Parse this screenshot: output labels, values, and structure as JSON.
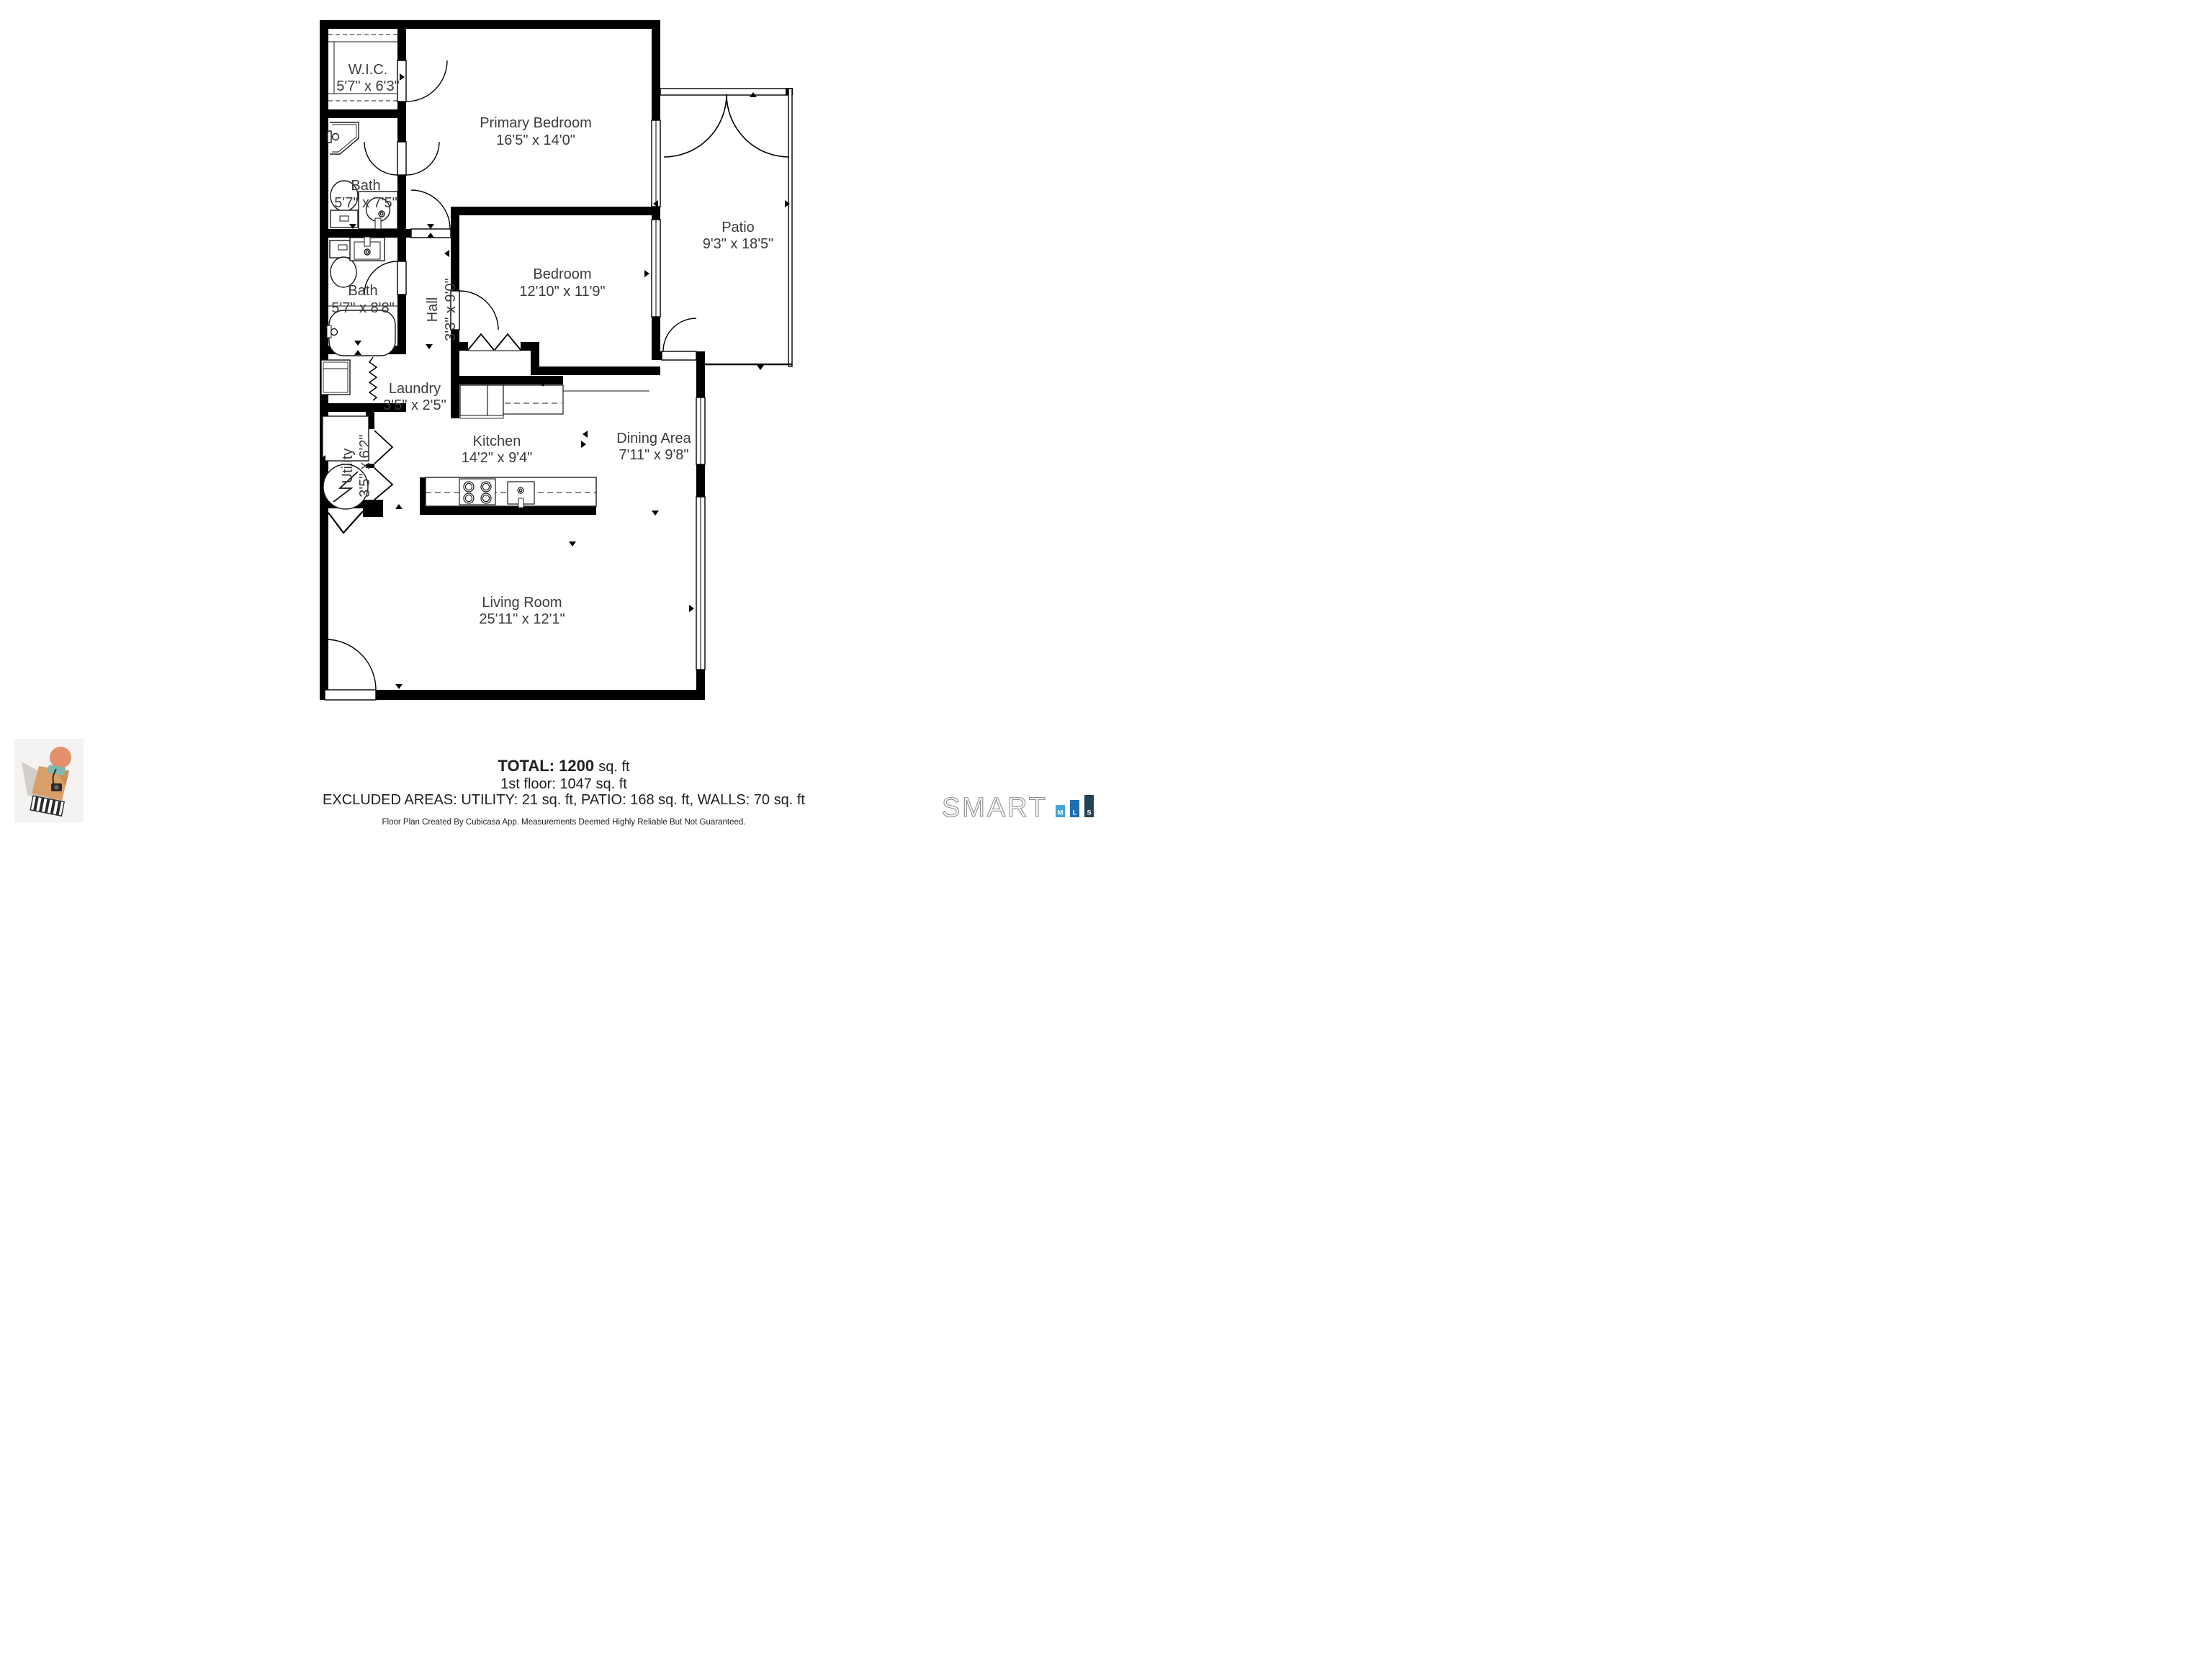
{
  "rooms": [
    {
      "id": "wic",
      "name": "W.I.C.",
      "dims": "5'7\" x 6'3\""
    },
    {
      "id": "bath1",
      "name": "Bath",
      "dims": "5'7\" x 7'5\""
    },
    {
      "id": "bath2",
      "name": "Bath",
      "dims": "5'7\" x 8'8\""
    },
    {
      "id": "hall",
      "name": "Hall",
      "dims": "3'3\" x 9'0\""
    },
    {
      "id": "laundry",
      "name": "Laundry",
      "dims": "3'5\" x 2'5\""
    },
    {
      "id": "utility",
      "name": "Utility",
      "dims": "3'5\" x 6'2\""
    },
    {
      "id": "primary_bedroom",
      "name": "Primary Bedroom",
      "dims": "16'5\" x 14'0\""
    },
    {
      "id": "bedroom",
      "name": "Bedroom",
      "dims": "12'10\" x 11'9\""
    },
    {
      "id": "patio",
      "name": "Patio",
      "dims": "9'3\" x 18'5\""
    },
    {
      "id": "kitchen",
      "name": "Kitchen",
      "dims": "14'2\" x 9'4\""
    },
    {
      "id": "dining",
      "name": "Dining Area",
      "dims": "7'11\" x 9'8\""
    },
    {
      "id": "living",
      "name": "Living Room",
      "dims": "25'11\" x 12'1\""
    }
  ],
  "summary": {
    "total_label": "TOTAL:",
    "total_value": "1200",
    "total_unit": "sq. ft",
    "first_floor": "1st floor: 1047 sq. ft",
    "excluded": "EXCLUDED AREAS: UTILITY: 21 sq. ft, PATIO: 168 sq. ft, WALLS: 70 sq. ft",
    "disclaimer": "Floor Plan Created By Cubicasa App. Measurements Deemed Highly Reliable But Not Guaranteed."
  },
  "branding": {
    "smart": "SMART",
    "mls": [
      "M",
      "L",
      "S"
    ],
    "mls_colors": [
      "#45a6dd",
      "#1e6fae",
      "#214353"
    ]
  }
}
